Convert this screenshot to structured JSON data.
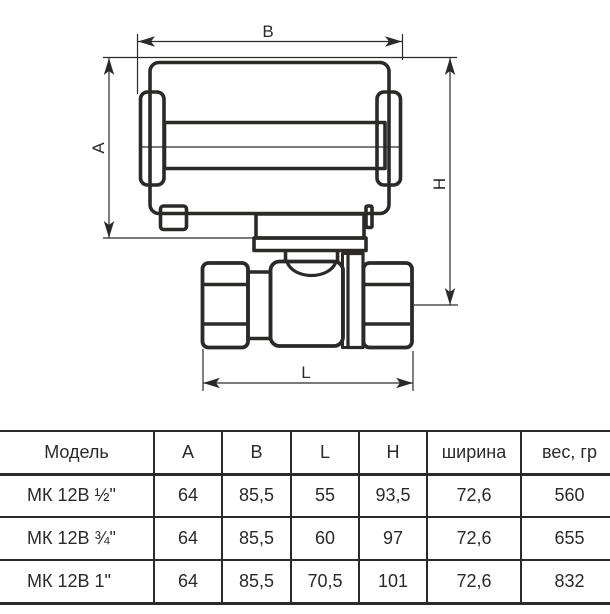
{
  "colors": {
    "line": "#2b2a29",
    "text": "#2b2a29",
    "background": "#ffffff"
  },
  "diagram": {
    "dim_labels": {
      "width_top": "B",
      "height_left": "A",
      "height_right": "H",
      "length_bottom": "L"
    }
  },
  "table": {
    "headers": [
      "Модель",
      "A",
      "B",
      "L",
      "H",
      "ширина",
      "вес, гр"
    ],
    "rows": [
      [
        "МК 12В ½\"",
        "64",
        "85,5",
        "55",
        "93,5",
        "72,6",
        "560"
      ],
      [
        "МК 12В ¾\"",
        "64",
        "85,5",
        "60",
        "97",
        "72,6",
        "655"
      ],
      [
        "МК 12В 1\"",
        "64",
        "85,5",
        "70,5",
        "101",
        "72,6",
        "832"
      ]
    ]
  }
}
